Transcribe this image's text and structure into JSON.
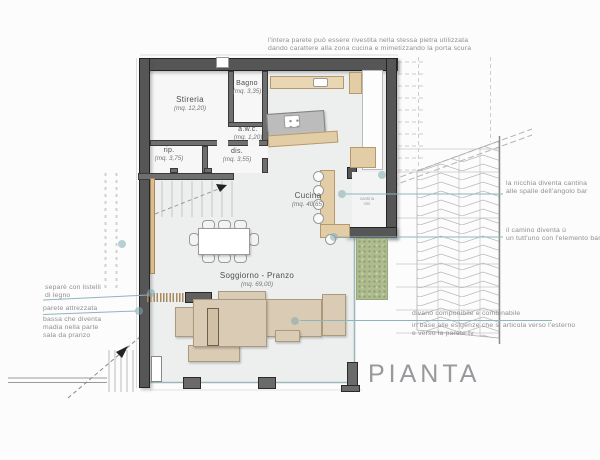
{
  "title": "PIANTA",
  "plan": {
    "rooms": [
      {
        "name": "Stireria",
        "area": "(mq. 12,20)"
      },
      {
        "name": "Bagno",
        "area": "(mq. 3,35)"
      },
      {
        "name": "a.w.c.",
        "area": "(mq. 1,20)"
      },
      {
        "name": "rip.",
        "area": "(mq. 3,75)"
      },
      {
        "name": "dis.",
        "area": "(mq. 3,55)"
      },
      {
        "name": "Cucina",
        "area": "(mq. 40,65)"
      },
      {
        "name": "Soggiorno - Pranzo",
        "area": "(mq. 69,00)"
      }
    ],
    "niche_label": [
      "cantina",
      "vini"
    ]
  },
  "annotations": {
    "top": [
      "l'intera parete può essere rivestita nella stessa pietra utilizzata",
      "dando carattere alla zona cucina e mimetizzando la porta scura"
    ],
    "right_niche": [
      "la nicchia diventa cantina",
      "alle spalle dell'angolo bar"
    ],
    "right_camino": [
      "il camino diventa ù",
      "un tutt'uno con l'elemento banc"
    ],
    "left_separe": [
      "separè con listelli",
      "di legno"
    ],
    "left_parete": [
      "parete attrezzata",
      "bassa che diventa",
      "madia nella parte",
      "sala da pranzo"
    ],
    "divano": [
      "divano componibile e combinabile",
      "in base alle esigenze che si articola verso l'esterno",
      "e verso la parete tv"
    ]
  },
  "colors": {
    "wall": "#565656",
    "accent_teal": "#8fb5ba",
    "wood": "#e3cda6",
    "sofa": "#dacbb4",
    "patio_green": "#adbb8e"
  }
}
